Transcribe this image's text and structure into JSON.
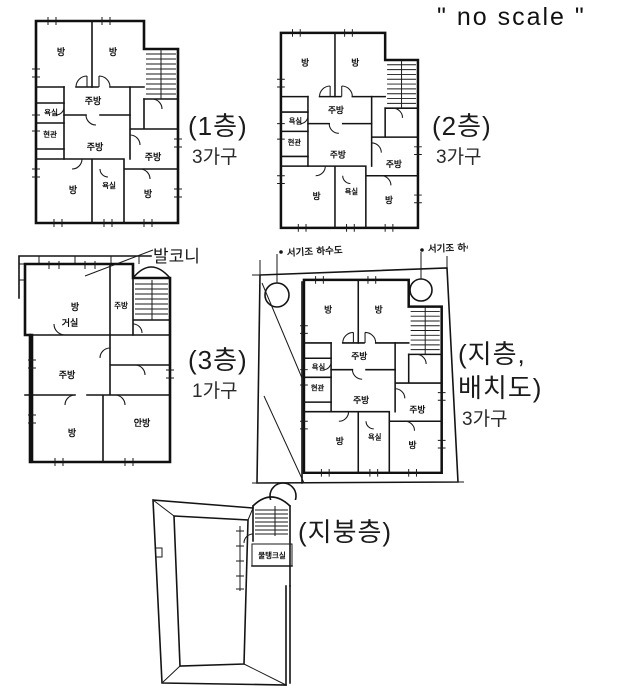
{
  "page": {
    "no_scale": "\" no scale \""
  },
  "rooms": {
    "bang": "방",
    "jubang": "주방",
    "yoksil": "욕실",
    "hyeongwan": "현관",
    "geosil": "거실",
    "anbang": "안방"
  },
  "plans": {
    "floor1": {
      "title": "(1층)",
      "units": "3가구"
    },
    "floor2": {
      "title": "(2층)",
      "units": "3가구"
    },
    "floor3": {
      "title": "(3층)",
      "units": "1가구",
      "balcony_label": "발코니"
    },
    "basement": {
      "title_line1": "(지층,",
      "title_line2": "배치도)",
      "units": "3가구",
      "annotation_left": "서기조 하수도",
      "annotation_right": "서기조 하수도"
    },
    "roof": {
      "title": "(지붕층)",
      "tank_label": "물탱크실"
    }
  }
}
